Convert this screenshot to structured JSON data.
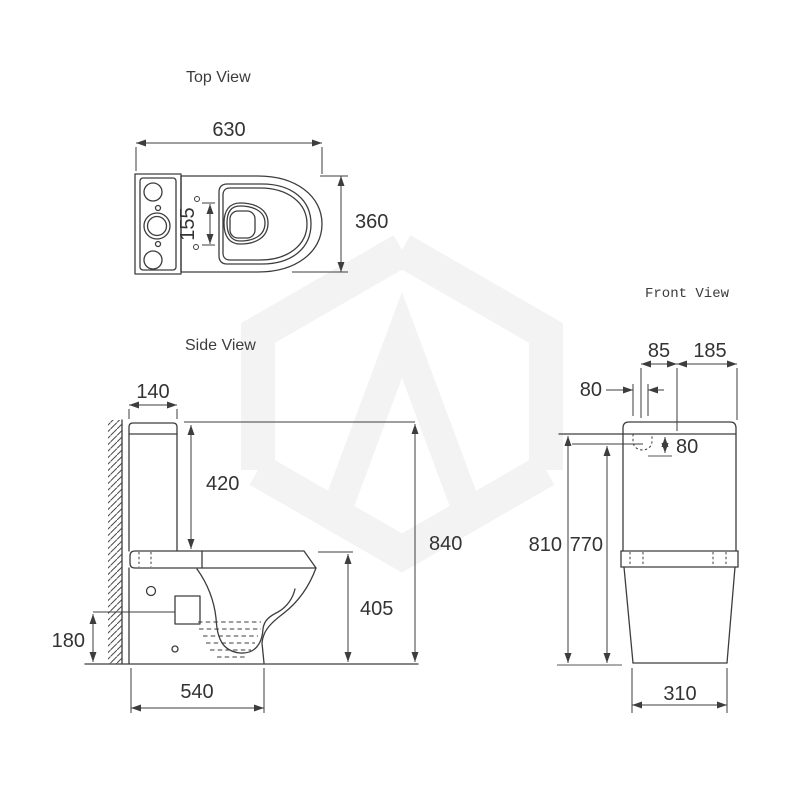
{
  "page": {
    "background": "#ffffff"
  },
  "watermark": {
    "description": "hexagon-logo-watermark",
    "color": "#f3f3f3"
  },
  "views": {
    "top": {
      "label": "Top View",
      "dims": {
        "overall_width": "630",
        "overall_depth": "360",
        "seat_hinge_spacing": "155"
      }
    },
    "side": {
      "label": "Side View",
      "dims": {
        "cistern_depth": "140",
        "cistern_height": "420",
        "overall_height": "840",
        "pan_height": "405",
        "inlet_height": "180",
        "pan_depth": "540"
      }
    },
    "front": {
      "label": "Front View",
      "dims": {
        "hole_offset": "85",
        "top_right_width": "185",
        "hole_gap": "80",
        "hole_depth": "80",
        "height_810": "810",
        "height_770": "770",
        "base_width": "310"
      }
    }
  }
}
